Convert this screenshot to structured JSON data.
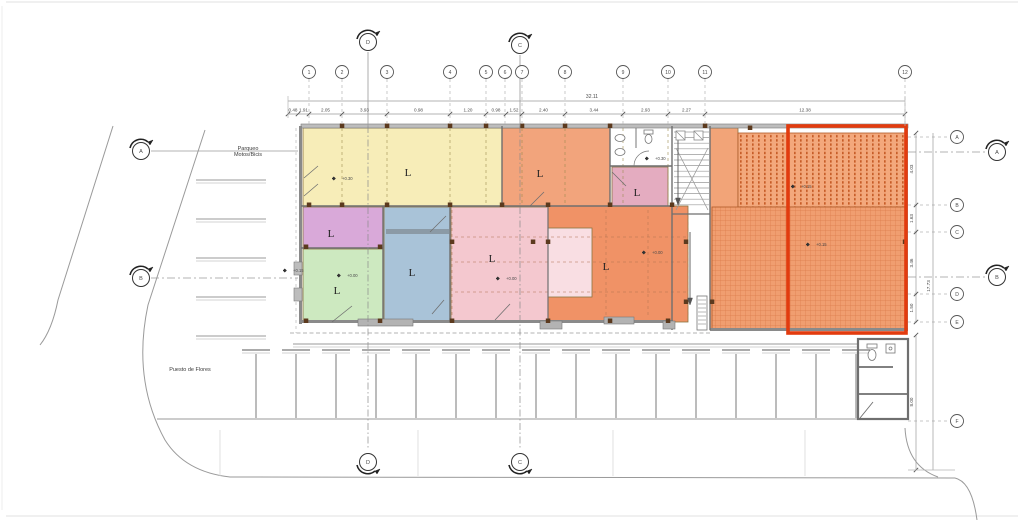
{
  "texts": {
    "parqueo_line1": "Parqueo",
    "parqueo_line2": "Motos/Bicis",
    "puesto": "Puesto de Flores",
    "overall_top": "32.11",
    "overall_right": "17.73",
    "annex_dim": "8.00"
  },
  "colors": {
    "wall": "#8a8a8a",
    "wall_dark": "#6f6f6f",
    "grid_line": "#b5b5b5",
    "dim_text": "#4a4a4a",
    "red_highlight": "#e23b0e",
    "hatch_dot": "#c2551f",
    "hatch_grid": "#dd7b4b",
    "column": "#5c3a1e"
  },
  "grid_top": {
    "y": 72,
    "bubbles": [
      {
        "n": "1",
        "x": 309
      },
      {
        "n": "2",
        "x": 342
      },
      {
        "n": "3",
        "x": 387
      },
      {
        "n": "4",
        "x": 450
      },
      {
        "n": "5",
        "x": 486
      },
      {
        "n": "6",
        "x": 505
      },
      {
        "n": "7",
        "x": 522
      },
      {
        "n": "8",
        "x": 565
      },
      {
        "n": "9",
        "x": 623
      },
      {
        "n": "10",
        "x": 668
      },
      {
        "n": "11",
        "x": 705
      },
      {
        "n": "12",
        "x": 905
      }
    ]
  },
  "grid_right": {
    "x": 957,
    "bubbles": [
      {
        "n": "A",
        "y": 137
      },
      {
        "n": "B",
        "y": 205
      },
      {
        "n": "C",
        "y": 232
      },
      {
        "n": "D",
        "y": 294
      },
      {
        "n": "E",
        "y": 322
      },
      {
        "n": "F",
        "y": 421
      }
    ]
  },
  "dims_top": {
    "line_y": 114,
    "overall_y": 101,
    "ticks": [
      288,
      298,
      309,
      342,
      387,
      450,
      486,
      506,
      522,
      565,
      623,
      668,
      705,
      905
    ],
    "labels": [
      "0.48",
      "1.91",
      "2.05",
      "3.93",
      "0.98",
      "1.20",
      "0.98",
      "1.52",
      "2.40",
      "3.44",
      "2.93",
      "2.27",
      "12.38"
    ]
  },
  "dims_right": {
    "line_x": 916,
    "ticks": [
      133,
      205,
      232,
      294,
      322
    ],
    "labels": [
      "4.03",
      "1.63",
      "3.46",
      "1.50"
    ],
    "annex_ticks": [
      335,
      470
    ],
    "overall_x": 933,
    "overall_span": [
      133,
      470
    ]
  },
  "sections": {
    "top": [
      {
        "l": "D",
        "x": 368,
        "y": 42
      },
      {
        "l": "C",
        "x": 520,
        "y": 45
      }
    ],
    "bottom": [
      {
        "l": "D",
        "x": 368,
        "y": 462
      },
      {
        "l": "C",
        "x": 520,
        "y": 462
      }
    ],
    "left": [
      {
        "l": "A",
        "x": 141,
        "y": 151
      },
      {
        "l": "B",
        "x": 141,
        "y": 278
      }
    ],
    "right": [
      {
        "l": "A",
        "x": 997,
        "y": 152
      },
      {
        "l": "B",
        "x": 997,
        "y": 277
      }
    ]
  },
  "rooms": [
    {
      "id": "room-yellow",
      "label": "L",
      "fill": "#f7edb8",
      "x": 303,
      "y": 128,
      "w": 199,
      "h": 78,
      "lx": 408,
      "ly": 176
    },
    {
      "id": "room-orange-top",
      "label": "L",
      "fill": "#f2a47c",
      "x": 502,
      "y": 128,
      "w": 108,
      "h": 78,
      "lx": 540,
      "ly": 177
    },
    {
      "id": "room-pink-small",
      "label": "L",
      "fill": "#e4acc0",
      "x": 612,
      "y": 167,
      "w": 56,
      "h": 39,
      "lx": 637,
      "ly": 196
    },
    {
      "id": "room-purple",
      "label": "L",
      "fill": "#d9a9d9",
      "x": 303,
      "y": 207,
      "w": 80,
      "h": 41,
      "lx": 331,
      "ly": 237
    },
    {
      "id": "room-green",
      "label": "L",
      "fill": "#cde9c0",
      "x": 303,
      "y": 249,
      "w": 80,
      "h": 73,
      "lx": 337,
      "ly": 294
    },
    {
      "id": "room-blue",
      "label": "L",
      "fill": "#a9c3d8",
      "x": 384,
      "y": 207,
      "w": 66,
      "h": 115,
      "lx": 412,
      "ly": 276
    },
    {
      "id": "room-pink",
      "label": "L",
      "fill": "#f4c8cf",
      "x": 451,
      "y": 207,
      "w": 97,
      "h": 114,
      "lx": 492,
      "ly": 262
    },
    {
      "id": "room-orange-big",
      "label": "L",
      "fill": "#f09266",
      "x": 548,
      "y": 206,
      "w": 140,
      "h": 116,
      "lx": 606,
      "ly": 270
    },
    {
      "id": "room-pink-inner",
      "label": "",
      "fill": "#f9dee3",
      "x": 548,
      "y": 228,
      "w": 44,
      "h": 69,
      "lx": 0,
      "ly": 0
    },
    {
      "id": "terrace-strip",
      "label": "",
      "fill": "#f2a478",
      "x": 710,
      "y": 128,
      "w": 28,
      "h": 202,
      "lx": 0,
      "ly": 0
    }
  ],
  "hatches": [
    {
      "id": "terrace-hatch-upper",
      "pattern": "dotsV",
      "x": 738,
      "y": 133,
      "w": 168,
      "h": 74
    },
    {
      "id": "terrace-hatch-lower",
      "pattern": "gridH",
      "x": 712,
      "y": 207,
      "w": 194,
      "h": 123
    }
  ],
  "highlight": {
    "x": 788,
    "y": 126,
    "w": 118,
    "h": 207
  },
  "elevations": [
    {
      "t": "+0.30",
      "x": 336,
      "y": 180
    },
    {
      "t": "+0.30",
      "x": 649,
      "y": 160
    },
    {
      "t": "+0.15",
      "x": 287,
      "y": 272
    },
    {
      "t": "+0.00",
      "x": 341,
      "y": 277
    },
    {
      "t": "+0.00",
      "x": 500,
      "y": 280
    },
    {
      "t": "+0.00",
      "x": 646,
      "y": 254
    },
    {
      "t": "+0.15",
      "x": 795,
      "y": 188
    },
    {
      "t": "+0.15",
      "x": 810,
      "y": 246
    }
  ]
}
